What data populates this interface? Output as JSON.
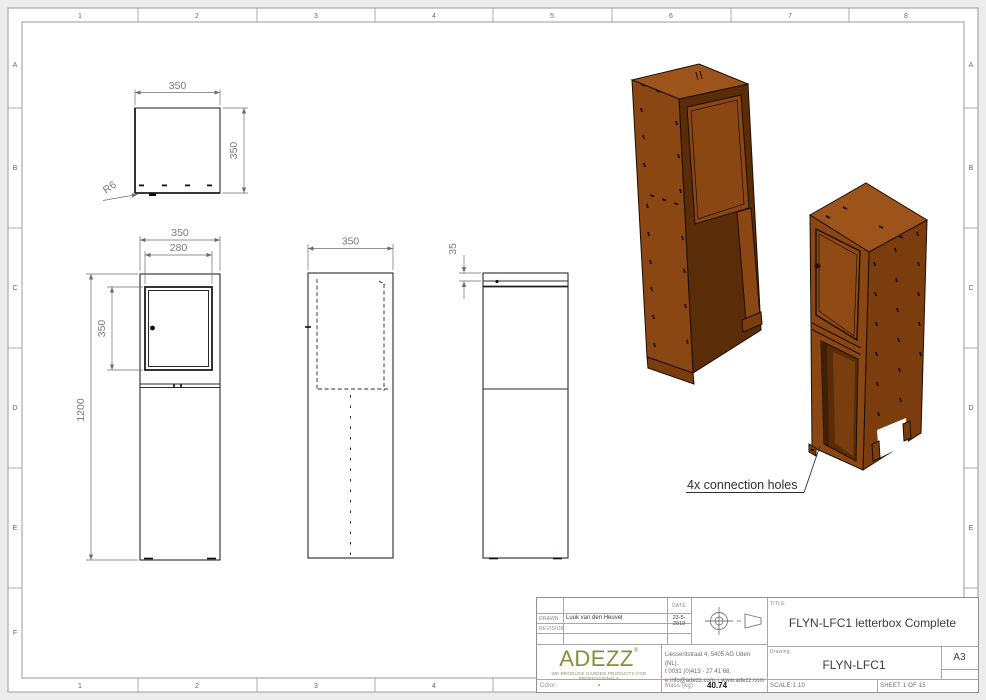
{
  "sheet": {
    "grid": {
      "cols": [
        "1",
        "2",
        "3",
        "4",
        "5",
        "6",
        "7",
        "8"
      ],
      "rows": [
        "A",
        "B",
        "C",
        "D",
        "E",
        "F"
      ]
    }
  },
  "views": {
    "top": {
      "width": "350",
      "depth": "350",
      "radius": "R6"
    },
    "front": {
      "width": "350",
      "door_width": "280",
      "door_height": "350",
      "height": "1200"
    },
    "side": {
      "width": "350"
    },
    "rear": {
      "slot": "35"
    }
  },
  "annotation": {
    "connection_holes": "4x connection holes"
  },
  "title_block": {
    "date_label": "DATE",
    "date_value": "23-5-2019",
    "drawn_label": "DRAWN",
    "drawn_value": "Luuk van den Heuvel",
    "revision_label": "REVISION",
    "company": "ADEZZ",
    "reg_mark": "®",
    "tagline": "WE PRODUCE GARDEN PRODUCTS FOR PROFESSIONALS",
    "address": "Liessentstraat 4, 5405 AG Uden (NL).",
    "phone_prefix": "t",
    "phone": "0031 (0)413 - 27 41 68.",
    "email_prefix": "e",
    "email": "info@adezz.com,",
    "web_prefix": "i",
    "web": "www.adezz.com",
    "title_label": "TITLE:",
    "title_value": "FLYN-LFC1 letterbox Complete",
    "drawing_label": "Drawing.",
    "drawing_value": "FLYN-LFC1",
    "paper_size": "A3",
    "scale": "SCALE:1:10",
    "sheet": "SHEET 1 OF 15",
    "color_label": "Color:",
    "color_value": "-",
    "mass_label": "Mass (kg):",
    "mass_value": "40.74"
  },
  "colors": {
    "corten_top": "#9c541b",
    "corten_face": "#8a4713",
    "corten_side": "#7b3d0e",
    "corten_interior": "#5a2c08",
    "adezz_green": "#8a8b3f",
    "contact_accent": "#e03c31",
    "line": "#2b2b2b",
    "dim_text": "#7a7a7a",
    "frame": "#9a9a9a"
  }
}
